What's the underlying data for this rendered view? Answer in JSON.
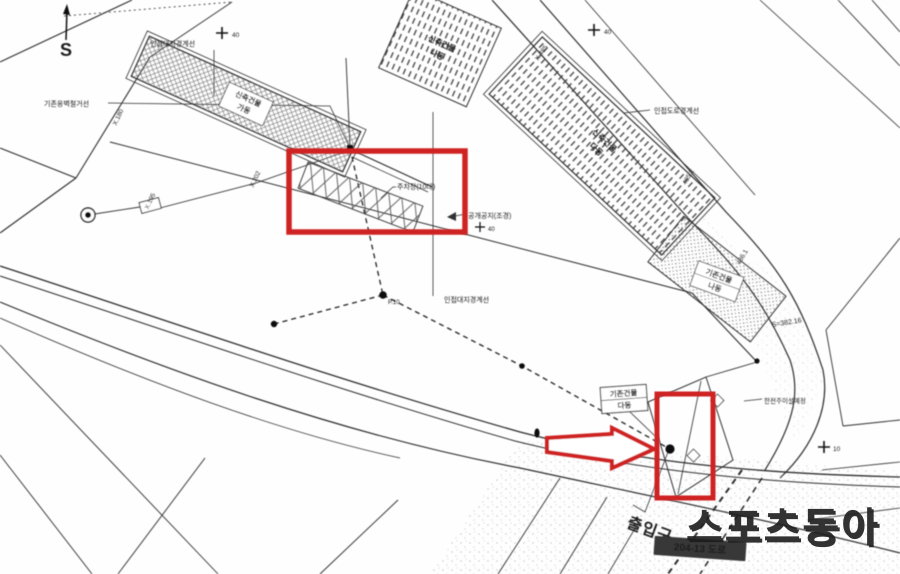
{
  "annotation_color": "#cf2020",
  "compass": {
    "label": "S"
  },
  "buildings": {
    "new_a": {
      "line1": "신축건물",
      "line2": "가동"
    },
    "new_b": {
      "line1": "신축건물",
      "line2": "나동"
    },
    "new_c": {
      "line1": "신축건물",
      "line2": "다동"
    },
    "exist_na": {
      "line1": "기존건물",
      "line2": "나동"
    },
    "exist_da": {
      "line1": "기존건물",
      "line2": "다동"
    }
  },
  "labels": {
    "parking": "주차장(10대)",
    "open_space": "공개공지(조경)",
    "adjacent_site_boundary_top": "인접대지경계선",
    "adjacent_site_boundary_mid": "인접대지경계선",
    "adjacent_road_boundary": "인접도로경계선",
    "retaining_wall_note": "기존옹벽철거선",
    "utility_pole_note": "한전주이설예정",
    "area_note": "S=382.16",
    "road_badge": "204-13 도로",
    "entrance": "출입구",
    "junction_mark": "P.10"
  },
  "elevations": [
    "X.180",
    "X.195",
    "X.202",
    "X.485",
    "485.2",
    "486.1"
  ],
  "trees": [
    "40",
    "40",
    "40",
    "10"
  ],
  "watermark": "스포츠동아"
}
